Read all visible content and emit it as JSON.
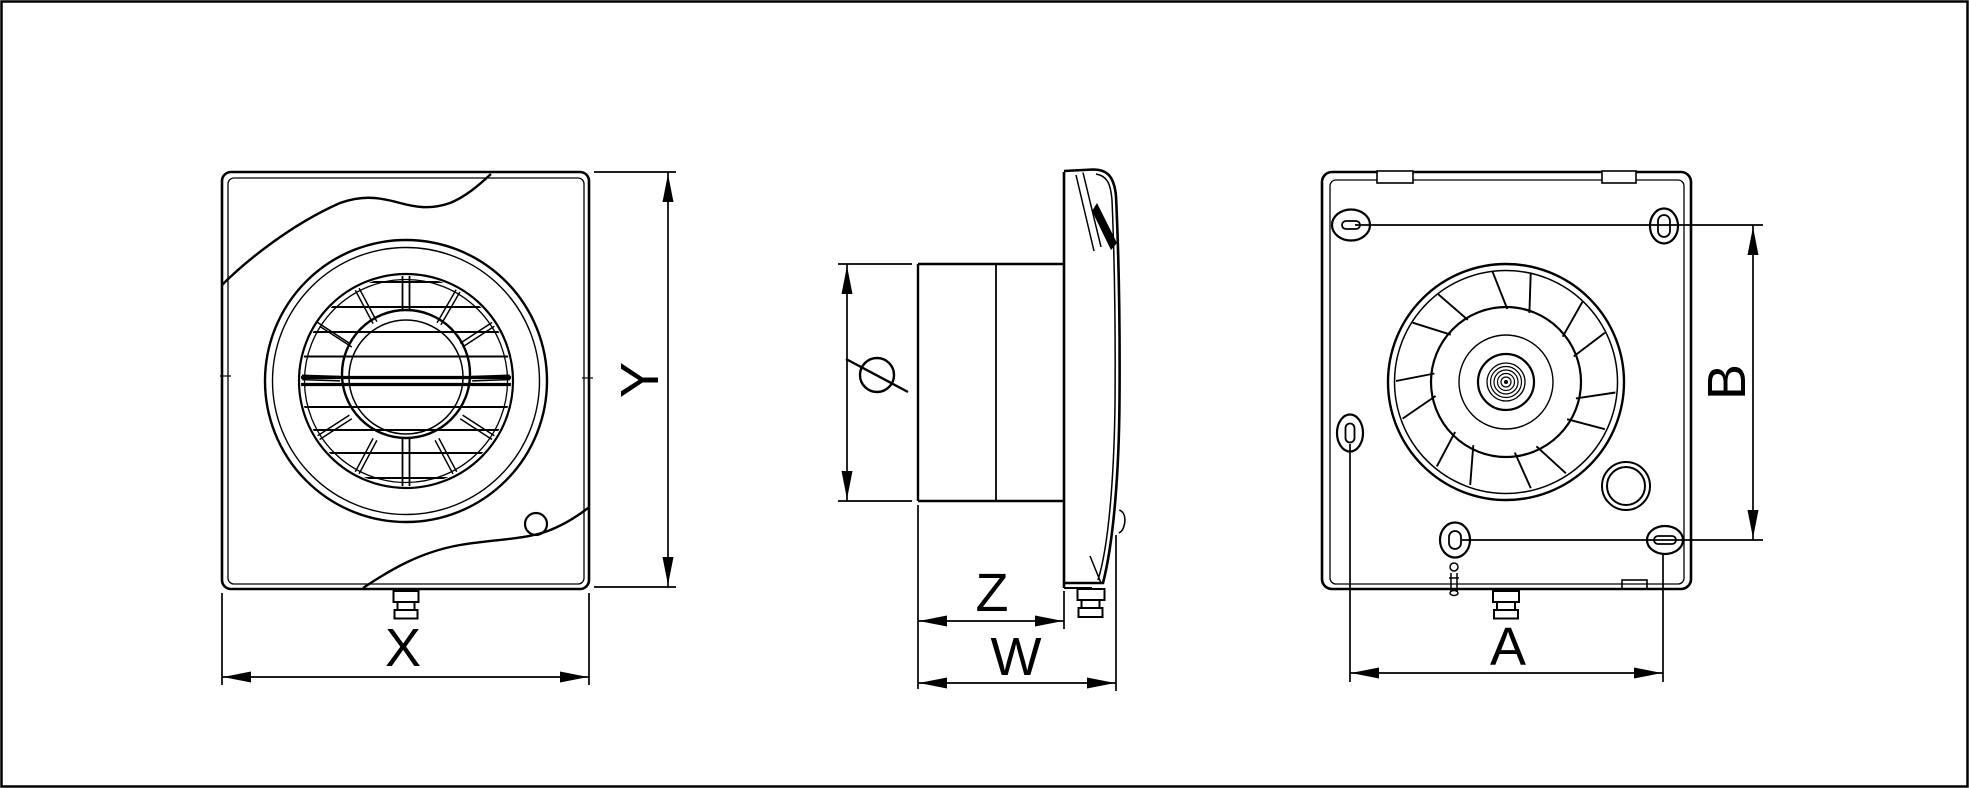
{
  "drawing": {
    "type": "technical-drawing",
    "subject": "wall extractor fan — three orthographic views (front, side, back)",
    "background": "#ffffff",
    "line_color": "#000000"
  },
  "dimensions": {
    "x": {
      "label": "X"
    },
    "y": {
      "label": "Y"
    },
    "z": {
      "label": "Z"
    },
    "w": {
      "label": "W"
    },
    "a": {
      "label": "A"
    },
    "b": {
      "label": "B"
    },
    "diameter": {
      "symbol": "Ø"
    }
  }
}
